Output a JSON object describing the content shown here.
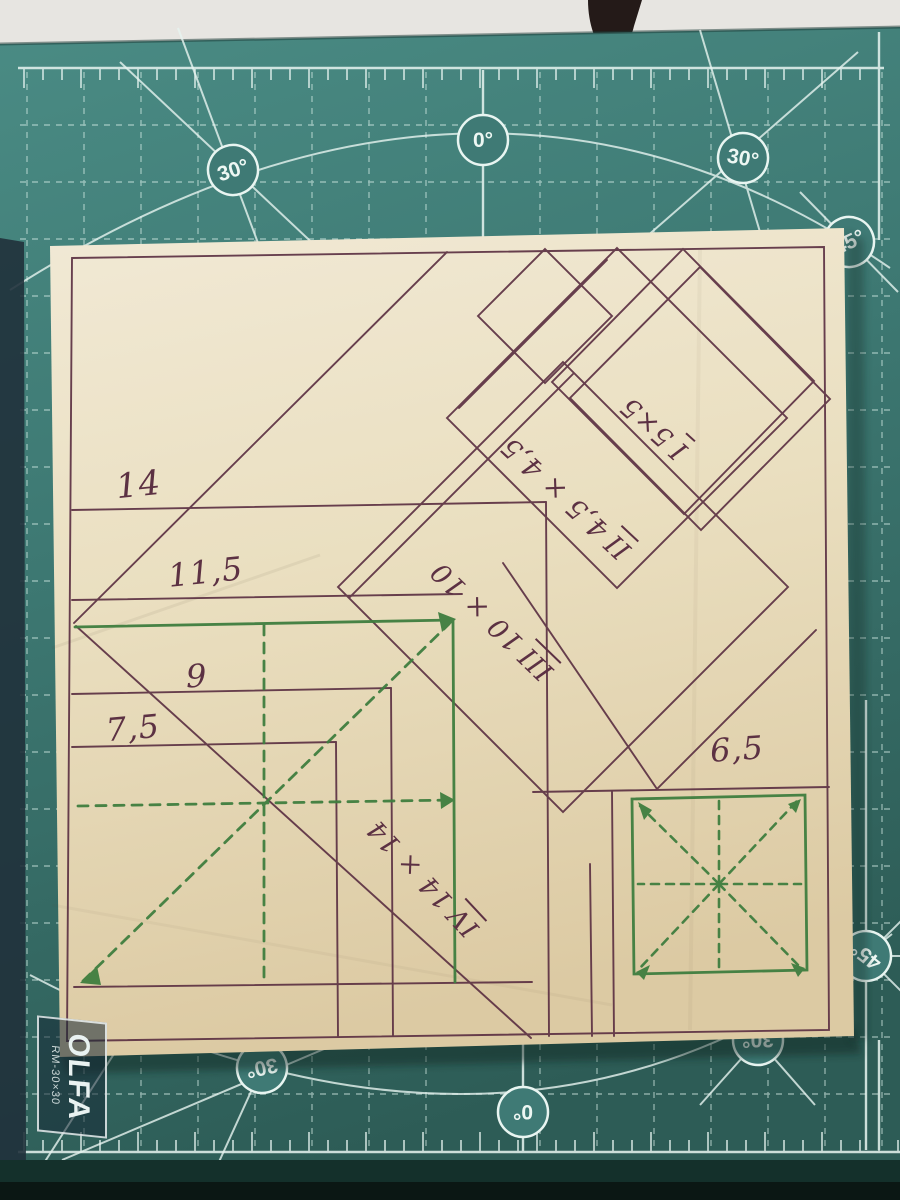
{
  "colors": {
    "table": "#e7e5e1",
    "mat": "#3f7a75",
    "mat_dark_band": "#14302b",
    "mat_grid": "#d9efe9",
    "paper": "#eee4c9",
    "ink_brown": "#5c3143",
    "ink_green": "#3f7e3f"
  },
  "mat": {
    "angle_labels": [
      {
        "text": "0°",
        "x": 483,
        "y": 140,
        "rot": 0
      },
      {
        "text": "30°",
        "x": 233,
        "y": 170,
        "rot": -18
      },
      {
        "text": "30°",
        "x": 743,
        "y": 158,
        "rot": 10
      },
      {
        "text": "45°",
        "x": 849,
        "y": 242,
        "rot": -25
      },
      {
        "text": "30°",
        "x": 262,
        "y": 1068,
        "rot": 168
      },
      {
        "text": "0°",
        "x": 523,
        "y": 1112,
        "rot": 180
      },
      {
        "text": "30°",
        "x": 758,
        "y": 1040,
        "rot": 180
      },
      {
        "text": "45°",
        "x": 866,
        "y": 956,
        "rot": -142
      }
    ],
    "logo": {
      "brand": "OLFA",
      "model": "RM-30×30"
    }
  },
  "drawing": {
    "measurements": [
      {
        "text": "14",
        "x": 116,
        "y": 468,
        "rot": -6,
        "size": 34
      },
      {
        "text": "11,5",
        "x": 168,
        "y": 556,
        "rot": -6,
        "size": 32
      },
      {
        "text": "9",
        "x": 186,
        "y": 660,
        "rot": -2,
        "size": 32
      },
      {
        "text": "7,5",
        "x": 106,
        "y": 712,
        "rot": -5,
        "size": 32
      },
      {
        "text": "6,5",
        "x": 710,
        "y": 733,
        "rot": -4,
        "size": 32
      }
    ],
    "pieces": [
      {
        "numeral": "I",
        "size": "5×5",
        "x": 654,
        "y": 428,
        "rot": -138,
        "fs": 27
      },
      {
        "numeral": "II",
        "size": "4,5 × 4,5",
        "x": 566,
        "y": 498,
        "rot": -137,
        "fs": 27
      },
      {
        "numeral": "III",
        "size": "10 × 10",
        "x": 492,
        "y": 621,
        "rot": -136,
        "fs": 27
      },
      {
        "numeral": "IV",
        "size": "14 × 14",
        "x": 423,
        "y": 878,
        "rot": -133,
        "fs": 26
      }
    ]
  }
}
